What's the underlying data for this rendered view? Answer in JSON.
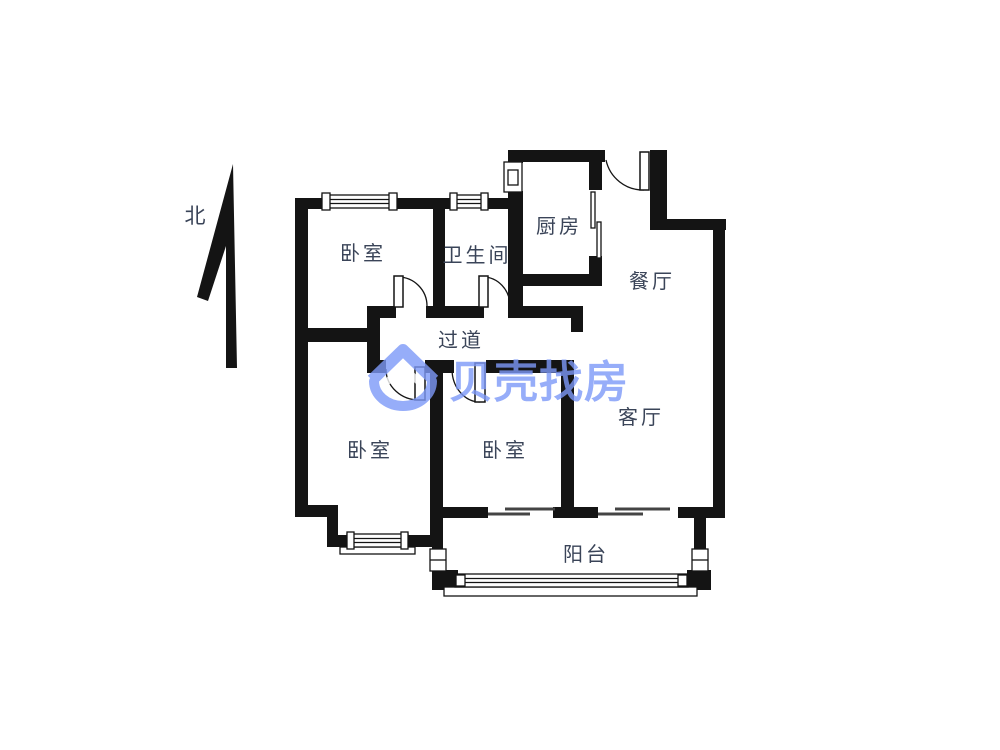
{
  "page": {
    "type": "real-estate-floor-plan",
    "background_color": "#ffffff",
    "wall_color": "#141414",
    "label_color": "#3a4458"
  },
  "compass": {
    "label": "北",
    "icon": "north-arrow-icon"
  },
  "watermark": {
    "brand": "贝壳找房",
    "icon": "beike-house-logo-icon",
    "color": "#7d99f8"
  },
  "floorplan": {
    "rooms": [
      {
        "id": "bedroom-north",
        "label": "卧室"
      },
      {
        "id": "bathroom",
        "label": "卫生间"
      },
      {
        "id": "kitchen",
        "label": "厨房"
      },
      {
        "id": "dining-room",
        "label": "餐厅"
      },
      {
        "id": "hallway",
        "label": "过道"
      },
      {
        "id": "bedroom-southwest",
        "label": "卧室"
      },
      {
        "id": "bedroom-south",
        "label": "卧室"
      },
      {
        "id": "living-room",
        "label": "客厅"
      },
      {
        "id": "balcony",
        "label": "阳台"
      }
    ],
    "features": [
      "entry-door",
      "bedroom-doors",
      "bathroom-door",
      "sliding-doors",
      "windows",
      "bay-window",
      "balcony-window"
    ]
  }
}
